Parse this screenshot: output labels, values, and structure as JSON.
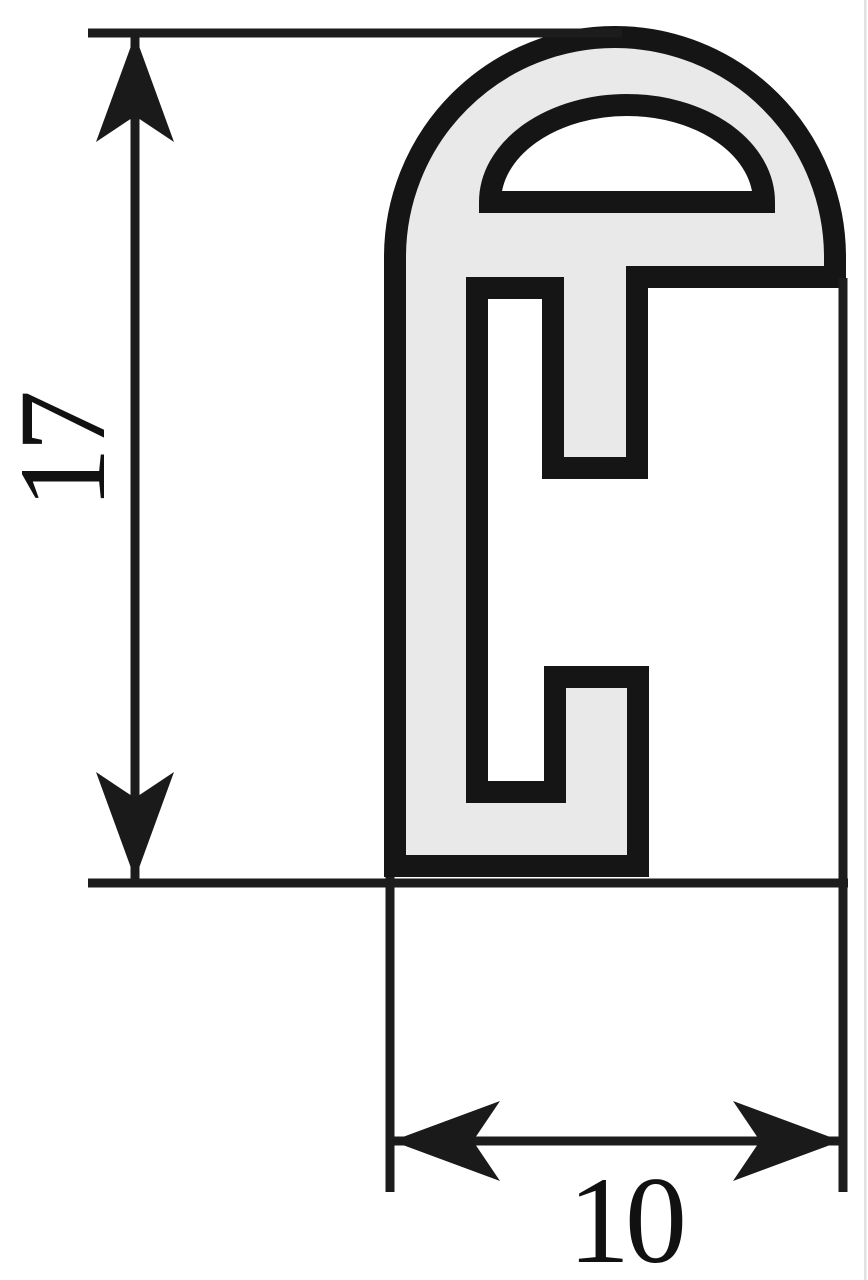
{
  "diagram": {
    "name": "extrusion-profile-cross-section",
    "dimensions": [
      {
        "id": "height",
        "label": "17",
        "orientation": "vertical"
      },
      {
        "id": "width",
        "label": "10",
        "orientation": "horizontal"
      }
    ],
    "colors": {
      "background": "#ffffff",
      "material_fill": "#e9e9e9",
      "outline": "#151515",
      "dimension_line": "#1c1c1c",
      "arrow": "#1a1a1a"
    }
  }
}
